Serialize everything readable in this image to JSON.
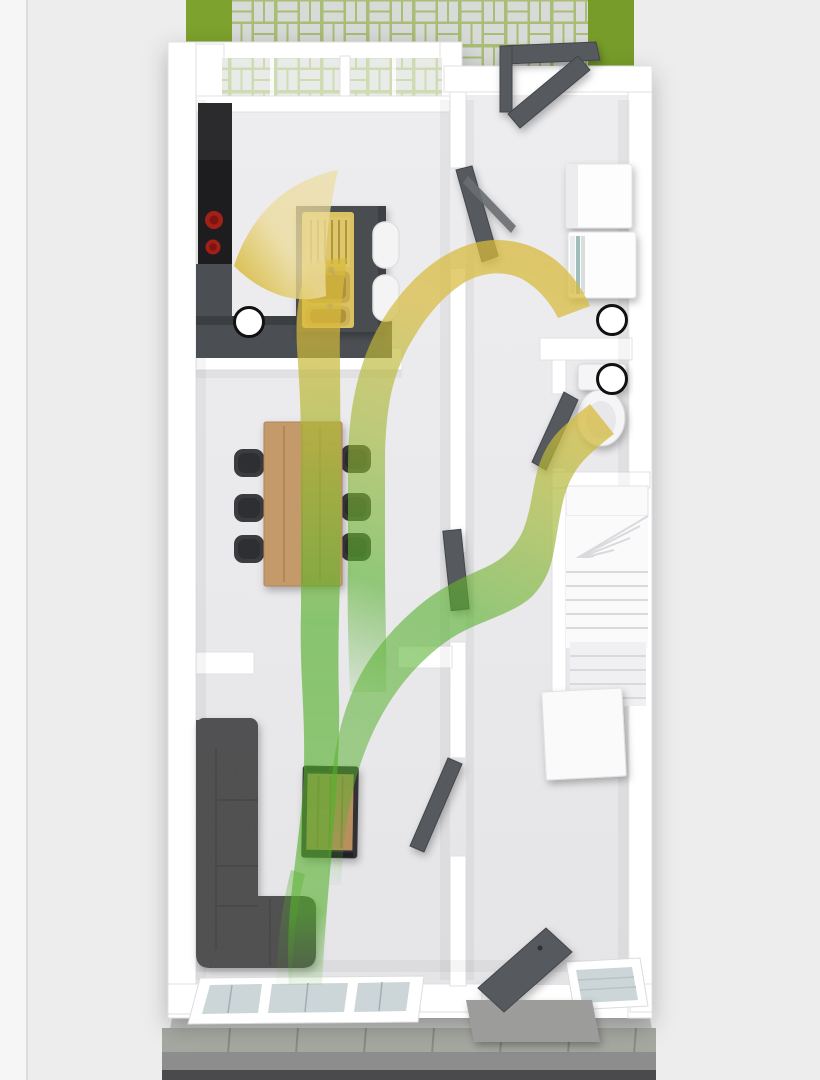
{
  "meta": {
    "title": "3D ground-floor plan with airflow overlay",
    "type": "architectural-render",
    "view": "top-down dollhouse"
  },
  "colors": {
    "bg": "#ededee",
    "bgStrip": "#f6f6f7",
    "wall": "#ffffff",
    "floor": "#eaeaec",
    "grass": "#7da22d",
    "grassDark": "#6d9226",
    "paver": "#d7dad6",
    "paverJoint": "#a9bd76",
    "doorGray": "#565a5e",
    "doorGrayDark": "#42464a",
    "counterDark": "#4b4e52",
    "counterEdge": "#3c3f42",
    "applianceBlack": "#1d1d1f",
    "hobRed": "#a32018",
    "hobRedDark": "#7c140f",
    "sinkGold": "#d9c25e",
    "sinkGoldDeep": "#b0923c",
    "stoolWhite": "#f4f4f5",
    "woodLight": "#c59a6a",
    "woodDark": "#a07745",
    "sofaGray": "#575757",
    "sofaArm": "#515153",
    "tableFrame": "#303335",
    "chairDark": "#3a3c3f",
    "chairPad": "#2d2f32",
    "stairWhite": "#fafafb",
    "stairShade": "#f0f0f2",
    "ceramic": "#f5f5f7",
    "glassCool": "#ccd5d8",
    "flowGreen": "#55b02c",
    "flowGreenYellow": "#9db634",
    "flowYellow": "#d8ba3c",
    "flowPale": "#ecdc9e",
    "markerFill": "#ffffff",
    "markerRing": "#111111",
    "pavement": "#a5a8a0",
    "pavementJoint": "#878c80",
    "baseTrim": "#c0c0be",
    "road": "#8d8d8d",
    "roadDark": "#4a4a4c",
    "applianceWhite": "#fdfdfe",
    "applianceSide": "#ececef"
  },
  "markers": {
    "radius": 14.5,
    "items": [
      {
        "name": "extract-valve-kitchen",
        "x": 249,
        "y": 322
      },
      {
        "name": "extract-valve-utility",
        "x": 612,
        "y": 320
      },
      {
        "name": "extract-valve-wc",
        "x": 612,
        "y": 379
      }
    ]
  },
  "dining": {
    "chairs": [
      {
        "x": 249,
        "y": 463
      },
      {
        "x": 249,
        "y": 508
      },
      {
        "x": 249,
        "y": 549
      },
      {
        "x": 356,
        "y": 459
      },
      {
        "x": 356,
        "y": 507
      },
      {
        "x": 356,
        "y": 547
      }
    ]
  },
  "kitchen": {
    "stools": [
      {
        "x": 386,
        "y": 245
      },
      {
        "x": 386,
        "y": 298
      }
    ]
  },
  "rooms": [
    {
      "name": "kitchen",
      "furniture": [
        "tall-unit",
        "oven",
        "hob",
        "worktops",
        "island-with-gold-sink",
        "bar-stools"
      ]
    },
    {
      "name": "utility-room",
      "furniture": [
        "white-appliance-unit",
        "white-appliance-unit-open"
      ]
    },
    {
      "name": "dining-room",
      "furniture": [
        "wooden-dining-table",
        "six-chairs"
      ]
    },
    {
      "name": "wc",
      "furniture": [
        "toilet-with-cistern"
      ]
    },
    {
      "name": "hallway",
      "furniture": [
        "winder-staircase",
        "understair-cupboard"
      ]
    },
    {
      "name": "living-room",
      "furniture": [
        "corner-sofa",
        "wooden-coffee-table"
      ]
    },
    {
      "name": "entrance",
      "furniture": [
        "front-door",
        "side-window"
      ]
    }
  ],
  "flows": [
    {
      "name": "airflow-living-to-kitchen",
      "from": "living-room-window",
      "to": "kitchen-extract-valve",
      "gradient": [
        "green",
        "yellow"
      ],
      "ends_with": "arrowhead"
    },
    {
      "name": "airflow-dining-to-utility",
      "from": "dining-area",
      "to": "utility-extract-valve",
      "gradient": [
        "green",
        "yellow"
      ]
    },
    {
      "name": "airflow-living-to-wc",
      "from": "living-room",
      "to": "wc-extract-valve",
      "gradient": [
        "green",
        "yellow"
      ]
    },
    {
      "name": "airflow-window-tail",
      "from": "bay-window",
      "to": "living-room",
      "gradient": [
        "green"
      ]
    }
  ],
  "exterior": {
    "rear": [
      "lawn",
      "block-paved-patio",
      "open-back-door-canopy"
    ],
    "front": [
      "bay-window",
      "entrance-step",
      "pavement",
      "kerb-stones",
      "road"
    ]
  }
}
